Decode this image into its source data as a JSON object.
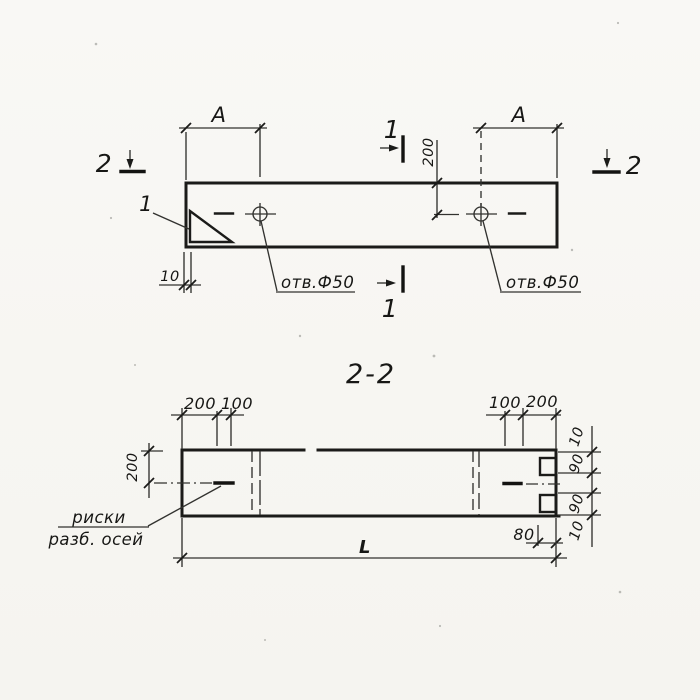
{
  "palette": {
    "ink": "#1b1b19",
    "paper": "#f8f7f4"
  },
  "plan": {
    "span_label_left": "A",
    "span_label_right": "A",
    "hole_offset_dim": "200",
    "edge_offset_dim": "10",
    "hole_note_left": "отв.Ф50",
    "hole_note_right": "отв.Ф50",
    "corner_detail_callout": "1",
    "section1_label": "1",
    "section2_label": "2"
  },
  "section": {
    "title": "2-2",
    "top_left_dims": [
      "200",
      "100"
    ],
    "top_right_dims": [
      "100",
      "200"
    ],
    "height_dim": "200",
    "right_dims": [
      "10",
      "90",
      "90",
      "10"
    ],
    "notch_depth_dim": "80",
    "length_dim": "L",
    "axes_note_line1": "риски",
    "axes_note_line2": "разб. осей"
  }
}
